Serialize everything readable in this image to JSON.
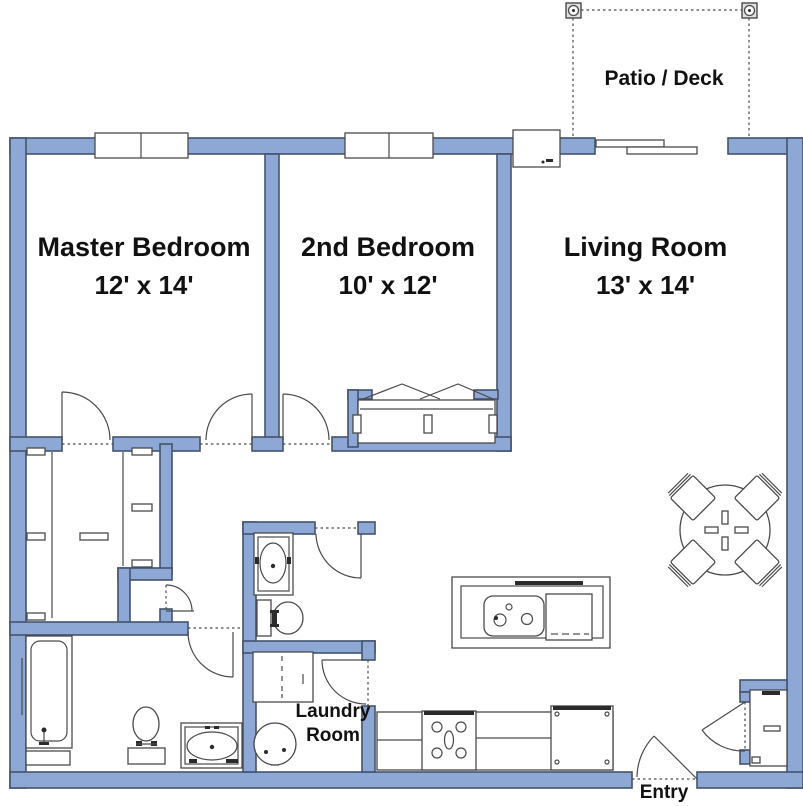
{
  "colors": {
    "bg": "#FFFFFF",
    "wall_fill": "#8DA8D4",
    "wall_stroke": "#44536E",
    "line": "#4A4A4A",
    "dark": "#2B2B2B",
    "post_fill": "#E0E0E0",
    "text": "#111111"
  },
  "rooms": {
    "master": {
      "name": "Master Bedroom",
      "dims": "12' x 14'"
    },
    "second": {
      "name": "2nd Bedroom",
      "dims": "10' x 12'"
    },
    "living": {
      "name": "Living Room",
      "dims": "13' x 14'"
    },
    "patio": {
      "name": "Patio / Deck"
    },
    "laundry": {
      "name": "Laundry Room"
    },
    "entry": {
      "name": "Entry"
    }
  },
  "fixtures": [
    "window",
    "sliding-glass-door",
    "fireplace-box",
    "patio-post",
    "door-swing",
    "closet-rod",
    "closet-shelf",
    "window-seat",
    "bathtub",
    "toilet",
    "vanity-sink",
    "washer-dryer",
    "water-heater",
    "kitchen-island-sink",
    "dishwasher",
    "range-stove",
    "refrigerator",
    "counter",
    "dining-table",
    "dining-chair",
    "coat-closet"
  ]
}
